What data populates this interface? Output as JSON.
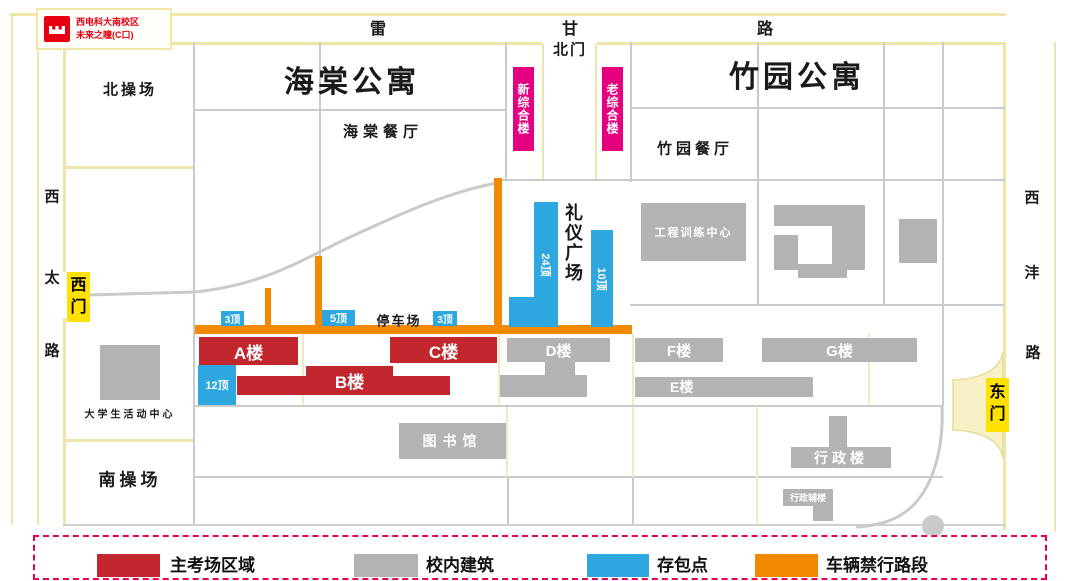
{
  "logo": {
    "line1": "西电科大南校区",
    "line2": "未来之瞳(C口)"
  },
  "roads": {
    "top_chars": [
      "雷",
      "甘",
      "路"
    ],
    "west_chars": [
      "西",
      "太",
      "路"
    ],
    "east_chars": [
      "西",
      "沣",
      "路"
    ]
  },
  "gates": {
    "north": "北门",
    "west": "西门",
    "east": "东门"
  },
  "labels": {
    "haitang_apt": "海棠公寓",
    "zhuyuan_apt": "竹园公寓",
    "north_field": "北操场",
    "south_field": "南操场",
    "haitang_canteen": "海棠餐厅",
    "zhuyuan_canteen": "竹园餐厅",
    "ceremony_square": "礼仪广场",
    "parking": "停车场",
    "student_center": "大学生活动中心",
    "new_complex": "新综合楼",
    "old_complex": "老综合楼",
    "engineering_center": "工程训练中心",
    "library": "图书馆",
    "admin": "行政楼",
    "admin_annex": "行政辅楼",
    "bldg_a": "A楼",
    "bldg_b": "B楼",
    "bldg_c": "C楼",
    "bldg_d": "D楼",
    "bldg_e": "E楼",
    "bldg_f": "F楼",
    "bldg_g": "G楼"
  },
  "storage": {
    "s3a": "3顶",
    "s5": "5顶",
    "s3b": "3顶",
    "s12": "12顶",
    "s24": "24顶",
    "s10": "10顶"
  },
  "legend": {
    "items": [
      {
        "label": "主考场区域",
        "color": "#C1272D"
      },
      {
        "label": "校内建筑",
        "color": "#B3B3B3"
      },
      {
        "label": "存包点",
        "color": "#2EA7E0"
      },
      {
        "label": "车辆禁行路段",
        "color": "#F18A00"
      }
    ]
  },
  "colors": {
    "exam_area": "#C1272D",
    "campus_building": "#B3B3B3",
    "storage_point": "#2EA7E0",
    "forbidden_road": "#F18A00",
    "complex_label": "#E4007F",
    "gate_badge": "#FFE100",
    "road_line": "#EFE5A8",
    "grid_line": "#C9CACA",
    "legend_border": "#E6004E",
    "logo_red": "#E60012"
  }
}
